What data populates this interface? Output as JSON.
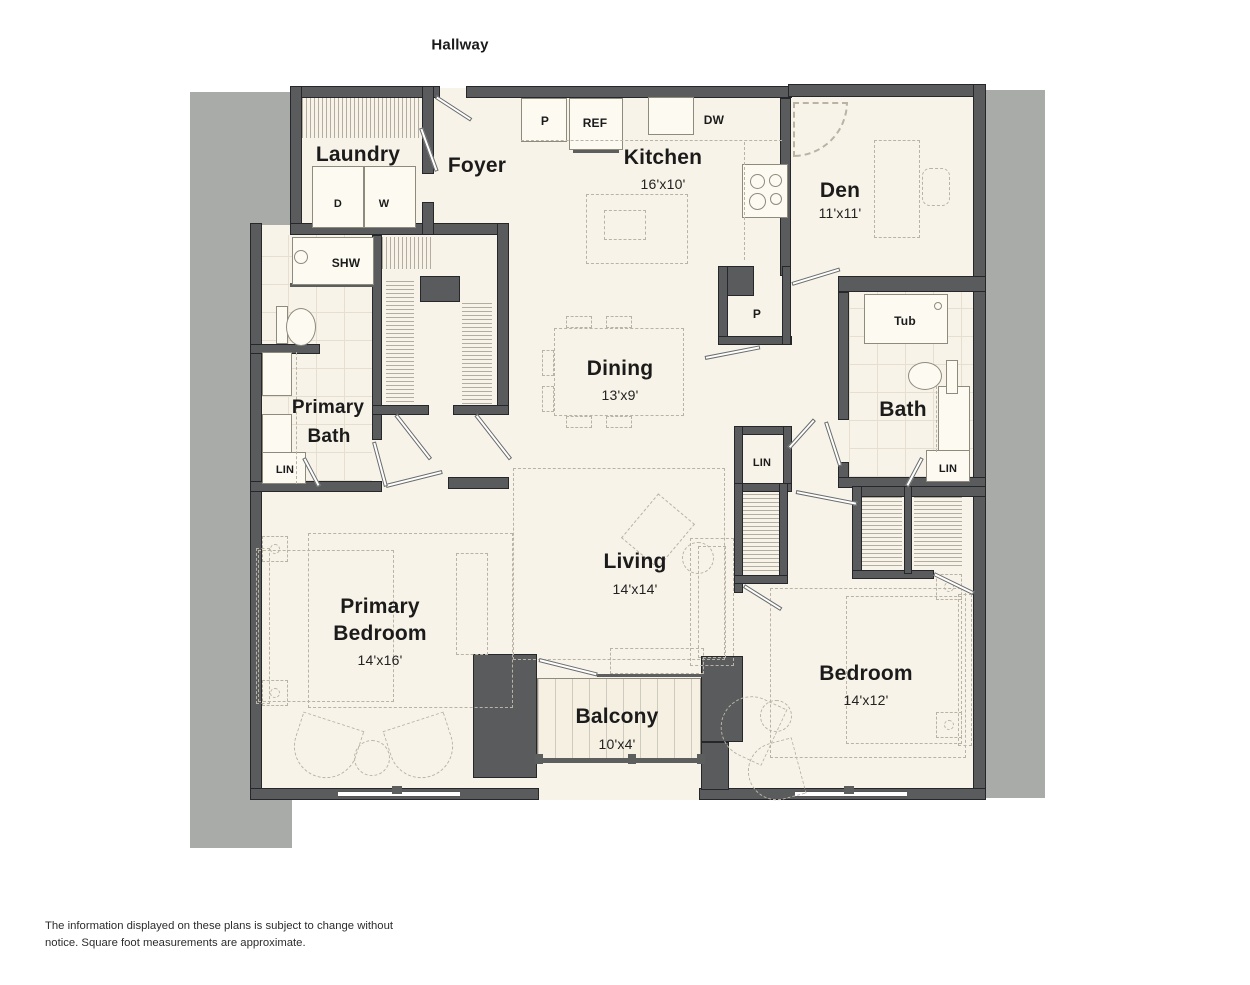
{
  "title": {
    "hallway": "Hallway"
  },
  "rooms": {
    "laundry": {
      "label": "Laundry"
    },
    "foyer": {
      "label": "Foyer"
    },
    "kitchen": {
      "label": "Kitchen",
      "dims": "16'x10'"
    },
    "den": {
      "label": "Den",
      "dims": "11'x11'"
    },
    "dining": {
      "label": "Dining",
      "dims": "13'x9'"
    },
    "living": {
      "label": "Living",
      "dims": "14'x14'"
    },
    "primary_bedroom": {
      "line1": "Primary",
      "line2": "Bedroom",
      "dims": "14'x16'"
    },
    "primary_bath": {
      "line1": "Primary",
      "line2": "Bath"
    },
    "bath": {
      "label": "Bath"
    },
    "bedroom": {
      "label": "Bedroom",
      "dims": "14'x12'"
    },
    "balcony": {
      "label": "Balcony",
      "dims": "10'x4'"
    }
  },
  "fixtures": {
    "kitchen_pantry": "P",
    "fridge": "REF",
    "dishwasher": "DW",
    "dryer": "D",
    "washer": "W",
    "shower": "SHW",
    "primary_bath_linen": "LIN",
    "hall_pantry": "P",
    "tub": "Tub",
    "hall_linen": "LIN",
    "bath_linen": "LIN"
  },
  "footer": {
    "disclaimer": "The information displayed on these plans is subject to change without notice. Square foot measurements are approximate."
  },
  "colors": {
    "floor": "#f8f3e8",
    "wall": "#595b5c",
    "shadow_gray": "#a9aba8",
    "furniture_line": "#b9b3a5"
  }
}
